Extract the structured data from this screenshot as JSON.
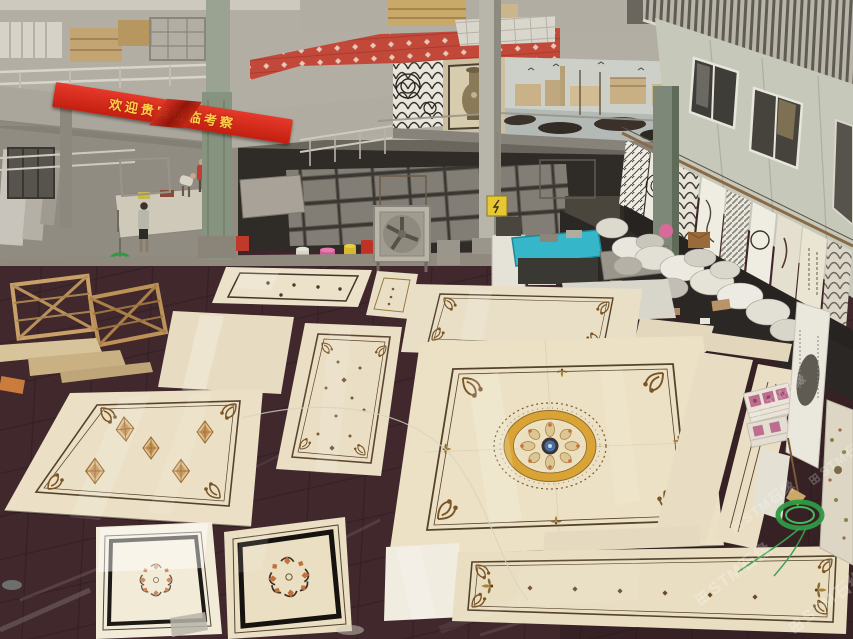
{
  "meta": {
    "subject": "Stone factory showroom interior with waterjet marble medallion floor panels laid out on a dark tiled floor"
  },
  "banner": {
    "text": "欢迎贵宾莅临考察",
    "bg": "#cf2415",
    "fg": "#ffd24a"
  },
  "watermark": {
    "logo": "⊞",
    "text": "STM石缘"
  },
  "palette": {
    "dark_floor": "#3c262b",
    "marble_cream": "#ebe0c5",
    "inlay_border": "#55422d",
    "medallion_gold": "#d9a435",
    "medallion_blue": "#4a6fa5",
    "banner_red": "#cf2415",
    "banner_yellow": "#ffd24a",
    "mezzanine_tile_red": "#c2493a",
    "concrete": "#918c82",
    "column_green": "#7d8878",
    "building_wall": "#c6c8b9",
    "machine_cyan": "#35b6c9",
    "sack_white": "#e9e6de",
    "coil_green": "#2f9a44",
    "bucket_pink": "#d8589a",
    "bucket_yellow": "#d8b92a",
    "bucket_red": "#c03324"
  },
  "scene": {
    "murals": [
      {
        "name": "op-art-spiral-mosaic"
      },
      {
        "name": "ornate-vase-mosaic"
      },
      {
        "name": "venetian-harbor-mosaic"
      }
    ],
    "floor_panels": [
      {
        "id": "dotted-border-panel"
      },
      {
        "id": "small-ornate-runner"
      },
      {
        "id": "tall-ornate-runner"
      },
      {
        "id": "plain-slab"
      },
      {
        "id": "five-diamond-panel"
      },
      {
        "id": "scroll-corner-panel"
      },
      {
        "id": "grand-medallion-panel"
      },
      {
        "id": "black-frame-wreath-square-left"
      },
      {
        "id": "black-frame-wreath-square-right"
      },
      {
        "id": "plain-white-square"
      },
      {
        "id": "long-border-runner"
      },
      {
        "id": "side-strip-a"
      },
      {
        "id": "side-strip-b"
      }
    ],
    "equipment": [
      "exhaust-fan",
      "display-pedestal",
      "cyan-work-table",
      "paint-buckets",
      "steel-columns",
      "white-sacks",
      "wooden-crates",
      "art-display-boards",
      "green-strap-coil",
      "warning-sign"
    ],
    "people_count": 3
  }
}
